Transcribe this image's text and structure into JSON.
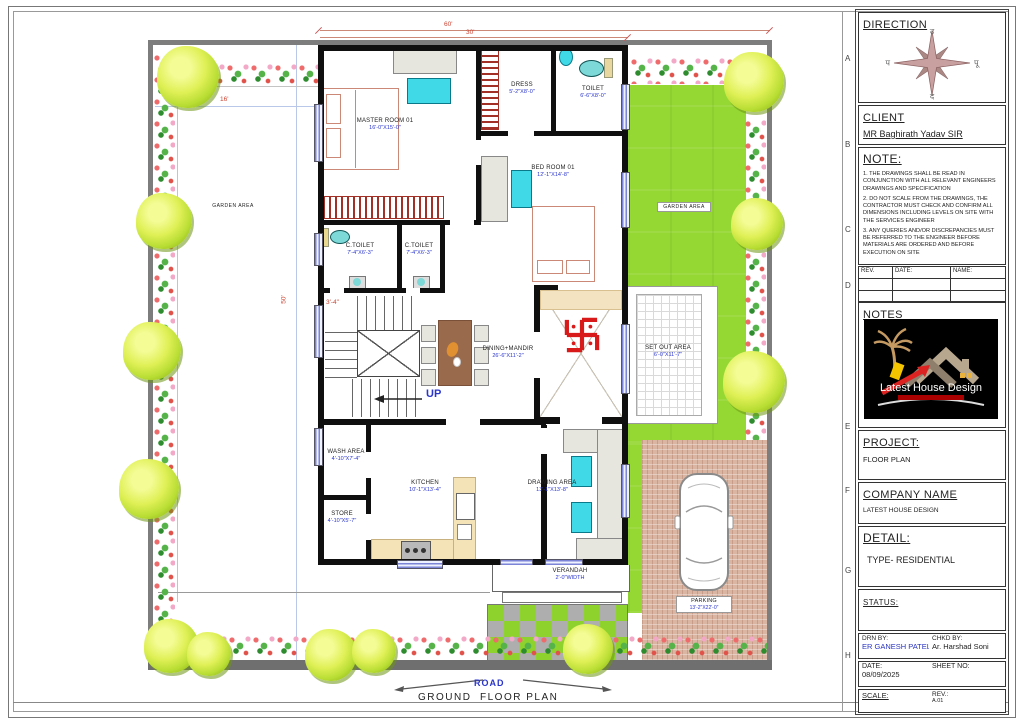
{
  "sheet": {
    "road_label": "ROAD",
    "caption": "GROUND  FLOOR PLAN",
    "grid_letters": [
      "A",
      "B",
      "C",
      "D",
      "E",
      "F",
      "G",
      "H"
    ]
  },
  "plan": {
    "rooms": {
      "master": {
        "name": "MASTER ROOM 01",
        "size": "16'-0\"X15'-0\""
      },
      "dress": {
        "name": "DRESS",
        "size": "5'-2\"X8'-0\""
      },
      "toilet": {
        "name": "TOILET",
        "size": "6'-6\"X8'-0\""
      },
      "bedroom": {
        "name": "BED ROOM 01",
        "size": "12'-1\"X14'-8\""
      },
      "ctoilet1": {
        "name": "C.TOILET",
        "size": "7'-4\"X6'-3\""
      },
      "ctoilet2": {
        "name": "C.TOILET",
        "size": "7'-4\"X6'-3\""
      },
      "dining": {
        "name": "DINING+MANDIR",
        "size": "26'-6\"X11'-2\""
      },
      "setout": {
        "name": "SET OUT AREA",
        "size": "6'-0\"X11'-7\""
      },
      "wash": {
        "name": "WASH AREA",
        "size": "4'-10\"X7'-4\""
      },
      "kitchen": {
        "name": "KITCHEN",
        "size": "10'-1\"X13'-4\""
      },
      "store": {
        "name": "STORE",
        "size": "4'-10\"X5'-7\""
      },
      "drawing": {
        "name": "DRAWING AREA",
        "size": "13'-1\"X13'-8\""
      },
      "verandah": {
        "name": "VERANDAH",
        "size": "2'-0\"WIDTH"
      },
      "parking": {
        "name": "PARKING",
        "size": "13'-2\"X22'-0\""
      },
      "garden_left": {
        "name": "GARDEN AREA"
      },
      "garden_right": {
        "name": "GARDEN AREA"
      }
    },
    "dims": {
      "plot_width": "60'",
      "house_width": "30'",
      "garden_width": "16'",
      "plot_height": "50'",
      "stair": "3'-4\""
    },
    "up_label": "UP"
  },
  "title_block": {
    "direction": {
      "label": "DIRECTION",
      "compass": {
        "north": "उ",
        "south": "द",
        "west": "प",
        "east": "पू"
      }
    },
    "client": {
      "label": "CLIENT",
      "name": "MR Baghirath Yadav SIR"
    },
    "note": {
      "label": "NOTE:",
      "items": [
        "1. THE DRAWINGS SHALL BE READ IN CONJUNCTION WITH ALL RELEVANT ENGINEERS DRAWINGS AND SPECIFICATION",
        "2. DO NOT SCALE FROM THE DRAWINGS, THE CONTRACTOR MUST CHECK AND CONFIRM ALL DIMENSIONS INCLUDING LEVELS ON SITE WITH THE SERVICES ENGINEER",
        "3. ANY QUERIES AND/OR DISCREPANCIES MUST BE REFERRED TO THE ENGINEER BEFORE MATERIALS ARE ORDERED AND BEFORE EXECUTION ON SITE"
      ]
    },
    "rev_table": {
      "headers": [
        "REV.",
        "DATE:",
        "NAME:"
      ]
    },
    "notes": {
      "label": "NOTES",
      "logo_text": "Latest House Design"
    },
    "project": {
      "label": "PROJECT:",
      "value": "FLOOR PLAN"
    },
    "company": {
      "label": "COMPANY NAME",
      "value": "LATEST HOUSE DESIGN"
    },
    "detail": {
      "label": "DETAIL:",
      "value": "TYPE- RESIDENTIAL"
    },
    "status": {
      "label": "STATUS:"
    },
    "drn_by": {
      "label": "DRN BY:",
      "value": "ER GANESH PATEL"
    },
    "chkd_by": {
      "label": "CHKD BY:",
      "value": "Ar. Harshad Soni"
    },
    "date": {
      "label": "DATE:",
      "value": "08/09/2025"
    },
    "sheet_no": {
      "label": "SHEET NO:"
    },
    "scale": {
      "label": "SCALE:"
    },
    "rev": {
      "label": "REV.:",
      "value": "A.01"
    }
  }
}
